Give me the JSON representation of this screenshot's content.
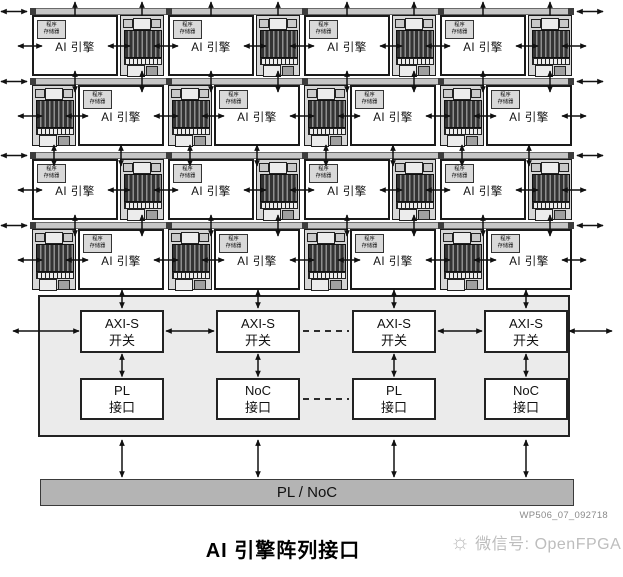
{
  "diagram": {
    "tile_array": {
      "rows": 4,
      "cols": 4,
      "engine_label": "AI 引擎",
      "program_memory_label": [
        "程序",
        "存储器"
      ],
      "row_orientations": [
        "engine-left",
        "memory-left",
        "engine-left",
        "memory-left"
      ]
    },
    "interface_section": {
      "switch_boxes": [
        [
          "AXI-S",
          "开关"
        ],
        [
          "AXI-S",
          "开关"
        ],
        [
          "AXI-S",
          "开关"
        ],
        [
          "AXI-S",
          "开关"
        ]
      ],
      "io_boxes": [
        [
          "PL",
          "接口"
        ],
        [
          "NoC",
          "接口"
        ],
        [
          "PL",
          "接口"
        ],
        [
          "NoC",
          "接口"
        ]
      ]
    },
    "bottom_bar": {
      "label": "PL / NoC"
    }
  },
  "footer": {
    "code": "WP506_07_092718",
    "caption": "AI 引擎阵列接口"
  },
  "watermark": {
    "icon": "sun-icon",
    "text": "微信号: OpenFPGA"
  },
  "colors": {
    "line": "#111111",
    "box_border": "#1a1a1a",
    "interface_bg": "#ebebeb",
    "bus_bar": "#c6c6c6",
    "bus_cap": "#3d3d3d",
    "memory_bg": "#d6d6d6",
    "label_bg": "#d9d9d9",
    "bottom_bar_bg": "#b4b4b4",
    "watermark_text": "#bdbdbd",
    "code_text": "#8a8a8a"
  }
}
